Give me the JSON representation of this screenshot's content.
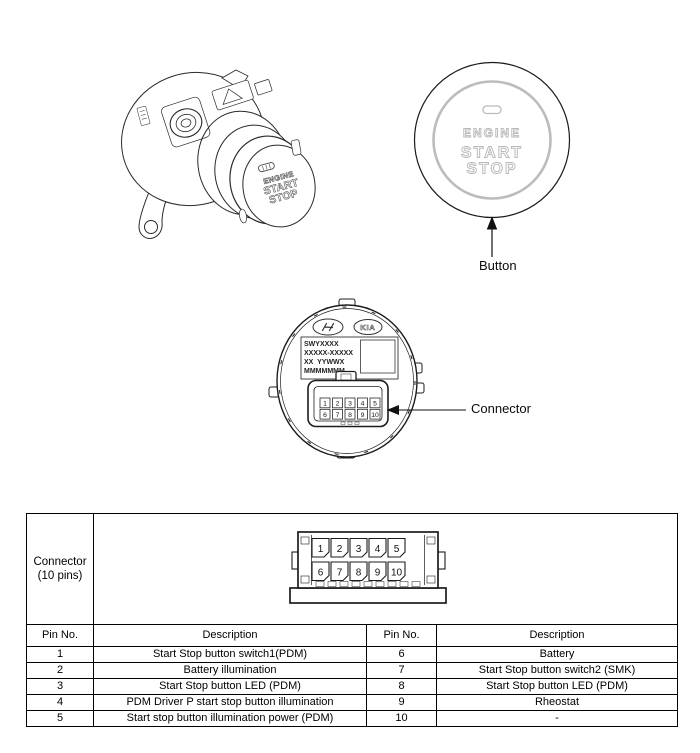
{
  "figures": {
    "assembly": {
      "face_lines": [
        "ENGINE",
        "START",
        "STOP"
      ]
    },
    "button_front": {
      "face_lines": [
        "ENGINE",
        "START",
        "STOP"
      ],
      "callout": "Button"
    },
    "back_view": {
      "kia_text": "KIA",
      "label_lines": [
        "SWYXXXX",
        "XXXXX-XXXXX",
        "XX  YYWWX",
        "MMMMMMM"
      ],
      "callout": "Connector"
    }
  },
  "pins": {
    "row1": [
      "1",
      "2",
      "3",
      "4",
      "5"
    ],
    "row2": [
      "6",
      "7",
      "8",
      "9",
      "10"
    ]
  },
  "connector_table": {
    "connector_cell_line1": "Connector",
    "connector_cell_line2": "(10 pins)",
    "headers": [
      "Pin No.",
      "Description",
      "Pin No.",
      "Description"
    ],
    "rows": [
      [
        "1",
        "Start Stop button switch1(PDM)",
        "6",
        "Battery"
      ],
      [
        "2",
        "Battery illumination",
        "7",
        "Start Stop button switch2 (SMK)"
      ],
      [
        "3",
        "Start Stop button LED (PDM)",
        "8",
        "Start Stop button LED (PDM)"
      ],
      [
        "4",
        "PDM Driver P start stop button illumination",
        "9",
        "Rheostat"
      ],
      [
        "5",
        "Start stop button illumination power (PDM)",
        "10",
        "-"
      ]
    ]
  },
  "colors": {
    "line": "#1c1c1c",
    "gray": "#b9b9b9"
  }
}
